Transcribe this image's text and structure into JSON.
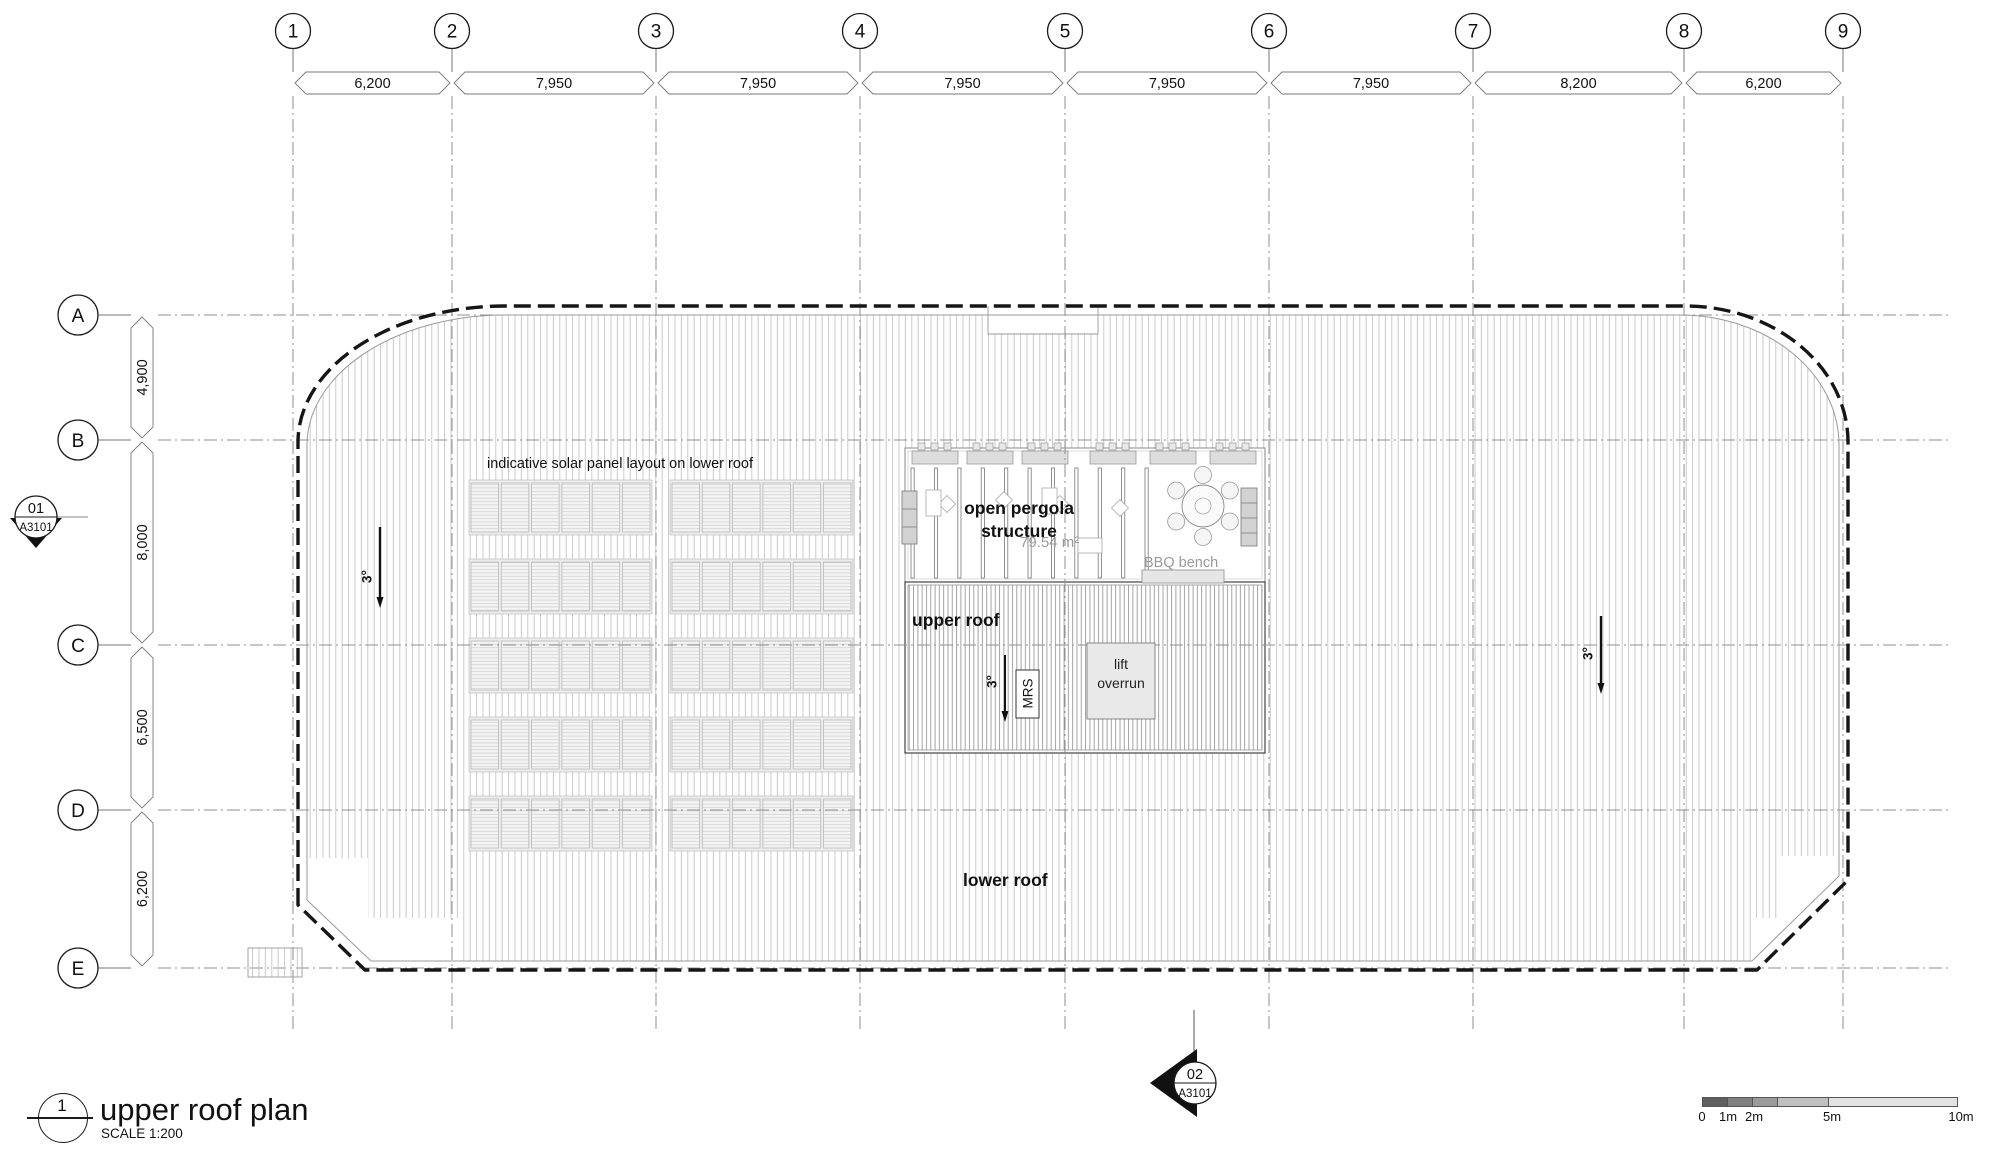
{
  "drawing": {
    "detail_number": "1",
    "title": "upper roof plan",
    "scale_label": "SCALE 1:200"
  },
  "grid": {
    "column_labels": [
      "1",
      "2",
      "3",
      "4",
      "5",
      "6",
      "7",
      "8",
      "9"
    ],
    "column_dims_mm": [
      "6,200",
      "7,950",
      "7,950",
      "7,950",
      "7,950",
      "7,950",
      "8,200",
      "6,200"
    ],
    "row_labels": [
      "A",
      "B",
      "C",
      "D",
      "E"
    ],
    "row_dims_mm": [
      "4,900",
      "8,000",
      "6,500",
      "6,200"
    ]
  },
  "labels": {
    "solar_note": "indicative solar panel layout on lower roof",
    "pergola_line1": "open pergola",
    "pergola_line2": "structure",
    "pergola_area": "79.54 m²",
    "bbq_bench": "BBQ bench",
    "upper_roof": "upper roof",
    "lower_roof": "lower roof",
    "lift_line1": "lift",
    "lift_line2": "overrun",
    "mrs": "MRS",
    "slope_left": "3°",
    "slope_center": "3°",
    "slope_right": "3°"
  },
  "section_markers": {
    "left": {
      "number": "01",
      "sheet": "A3101"
    },
    "bottom": {
      "number": "02",
      "sheet": "A3101"
    }
  },
  "scale_bar": {
    "labels": [
      "0",
      "1m",
      "2m",
      "5m",
      "10m"
    ]
  },
  "colors": {
    "outline": "#161616",
    "grid_line": "#8f8f8f",
    "hatch": "#c4c4c4",
    "hatch_dense": "#9a9a9a",
    "box_fill": "#e9e9e9",
    "muted_text": "#9a9a9a",
    "scale_bar_shades": [
      "#5f5f5f",
      "#808080",
      "#9b9b9b",
      "#c0c0c0",
      "#e3e3e3"
    ]
  }
}
